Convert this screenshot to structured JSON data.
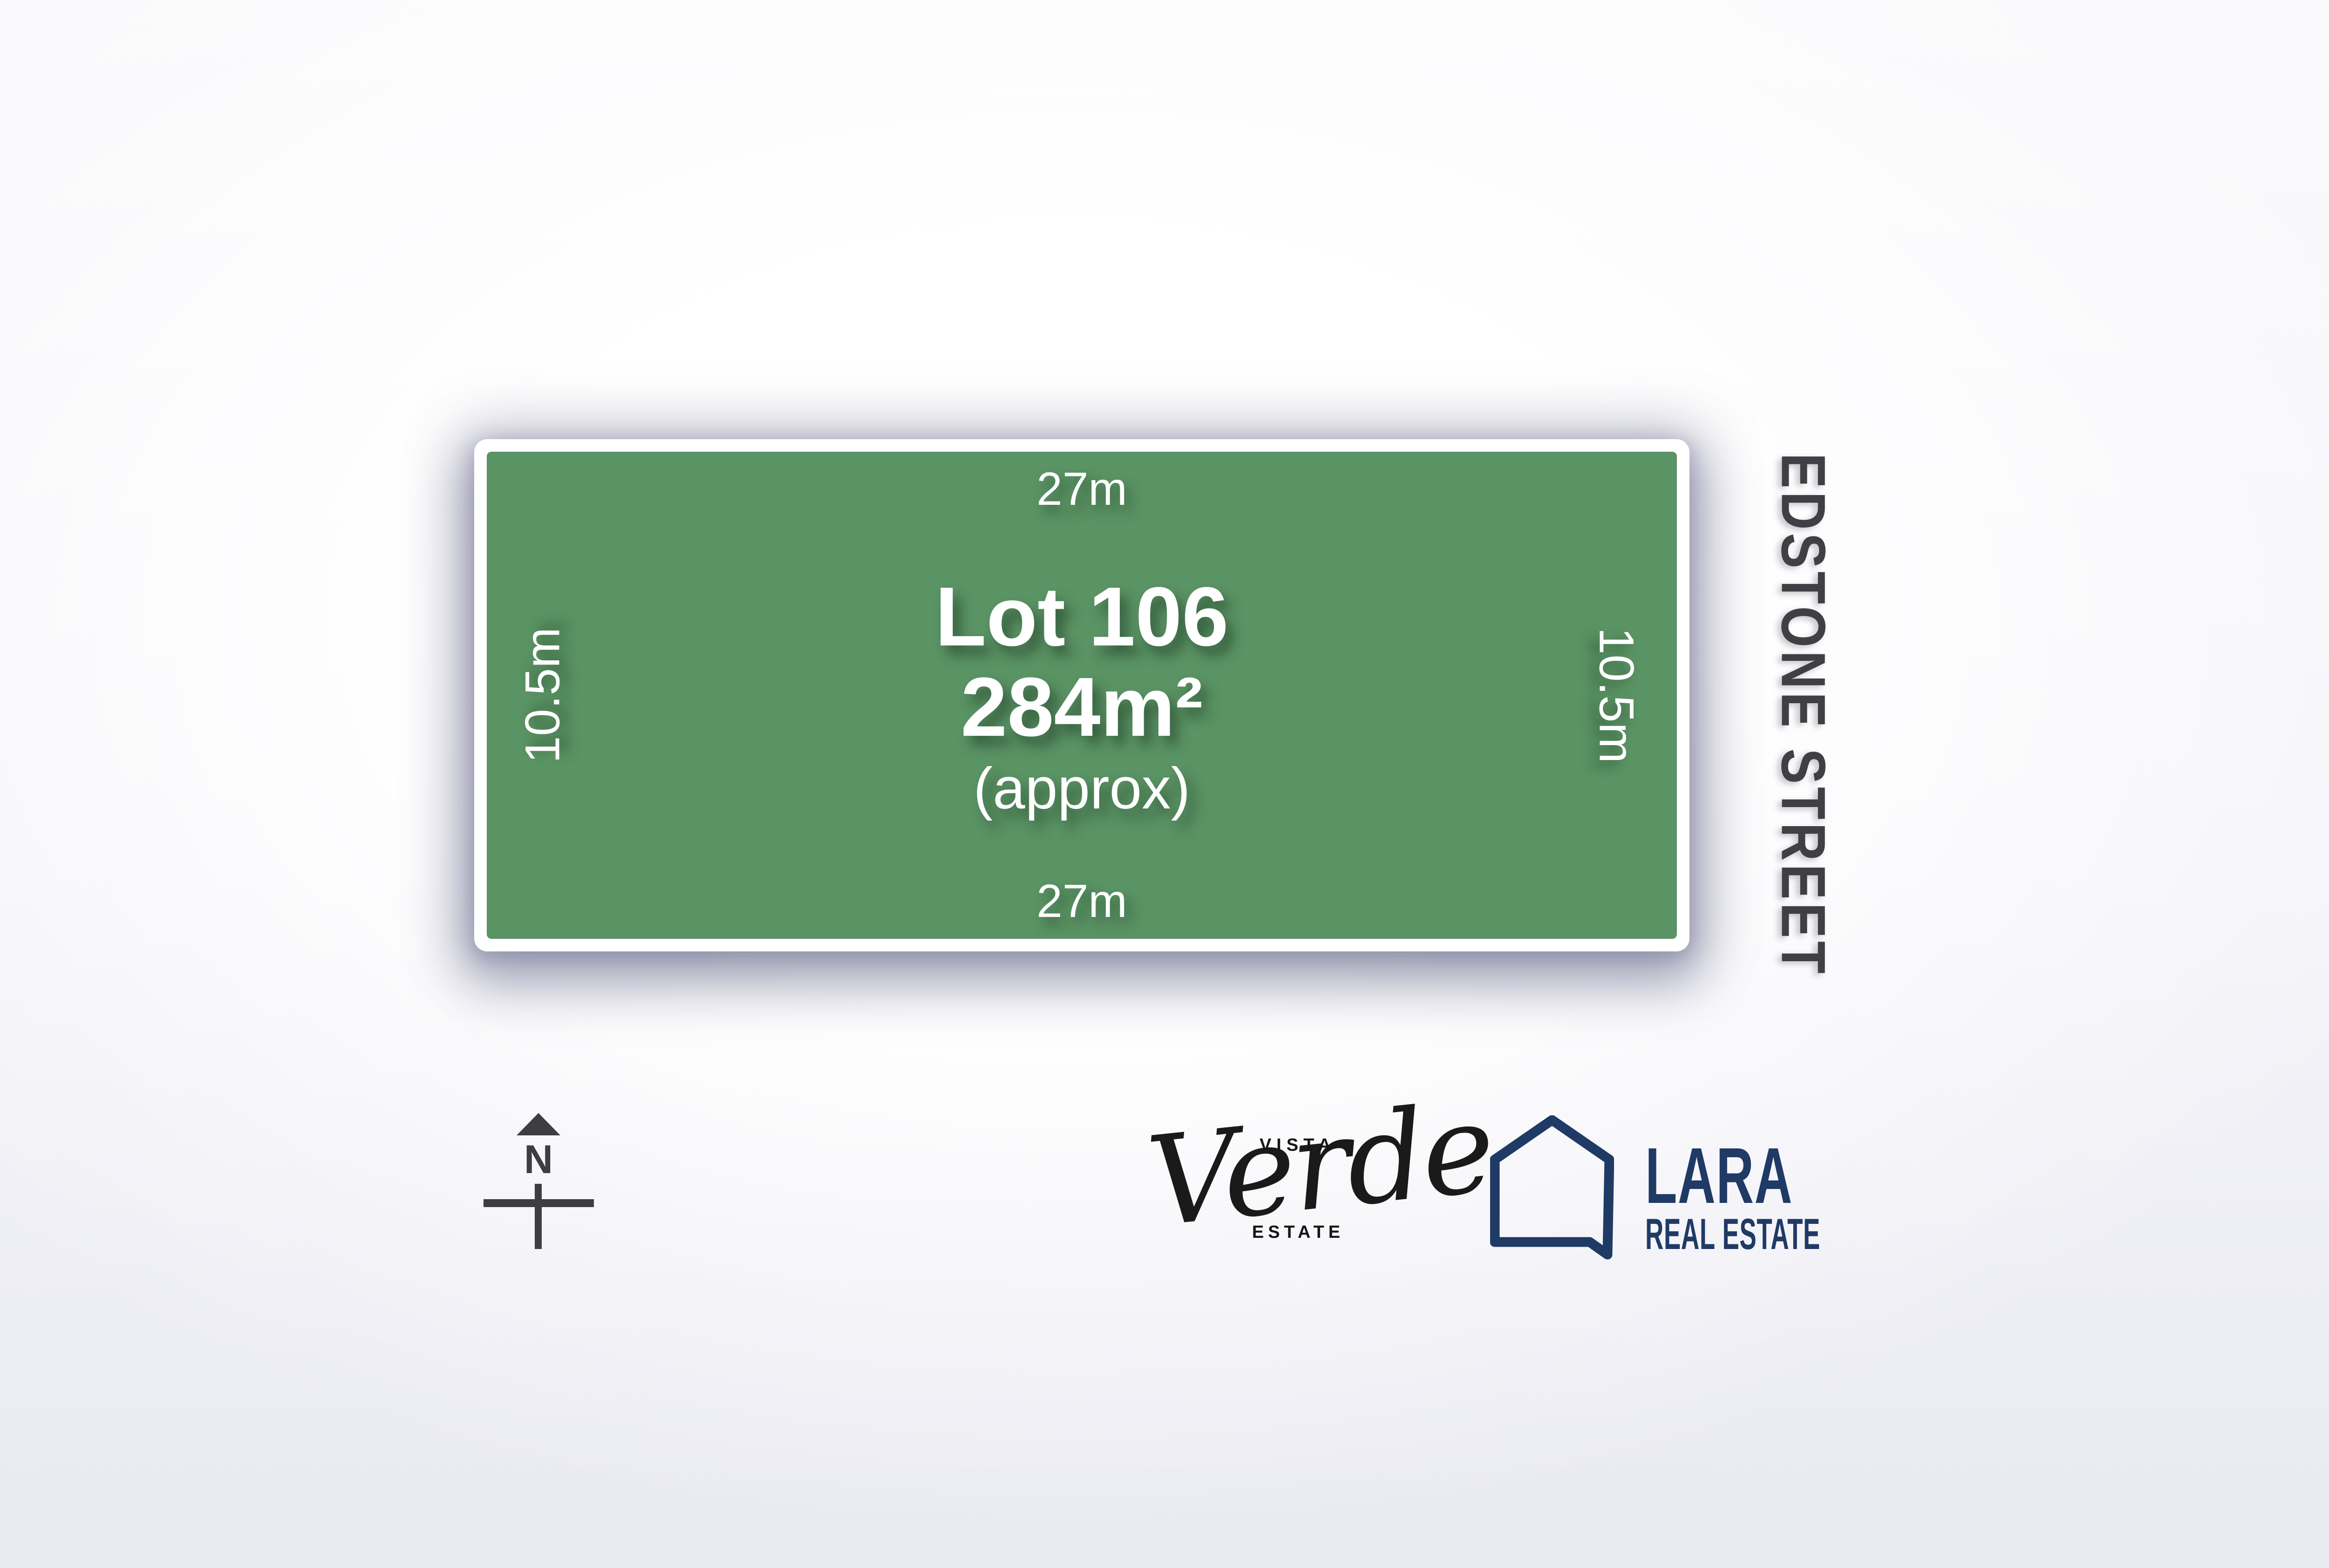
{
  "theme": {
    "lot_fill": "#5a9364",
    "frame_color": "#ffffff",
    "street_text": "#3f3f44",
    "compass_color": "#3e3e42",
    "script_text": "#1a1a1a",
    "lara_navy": "#203a66",
    "bg_tint": "#e9e9f1"
  },
  "lot": {
    "label": "Lot 106",
    "area": "284m²",
    "area_qualifier": "(approx)",
    "top_dimension": "27m",
    "bottom_dimension": "27m",
    "left_dimension": "10.5m",
    "right_dimension": "10.5m"
  },
  "street": {
    "name": "EDSTONE STREET"
  },
  "compass": {
    "north_label": "N"
  },
  "logos": {
    "vista_verde": {
      "line_top": "VISTA",
      "script": "Verde",
      "line_bottom": "ESTATE"
    },
    "lara": {
      "name": "LARA",
      "subtitle": "REAL ESTATE",
      "icon": "house-outline"
    }
  }
}
